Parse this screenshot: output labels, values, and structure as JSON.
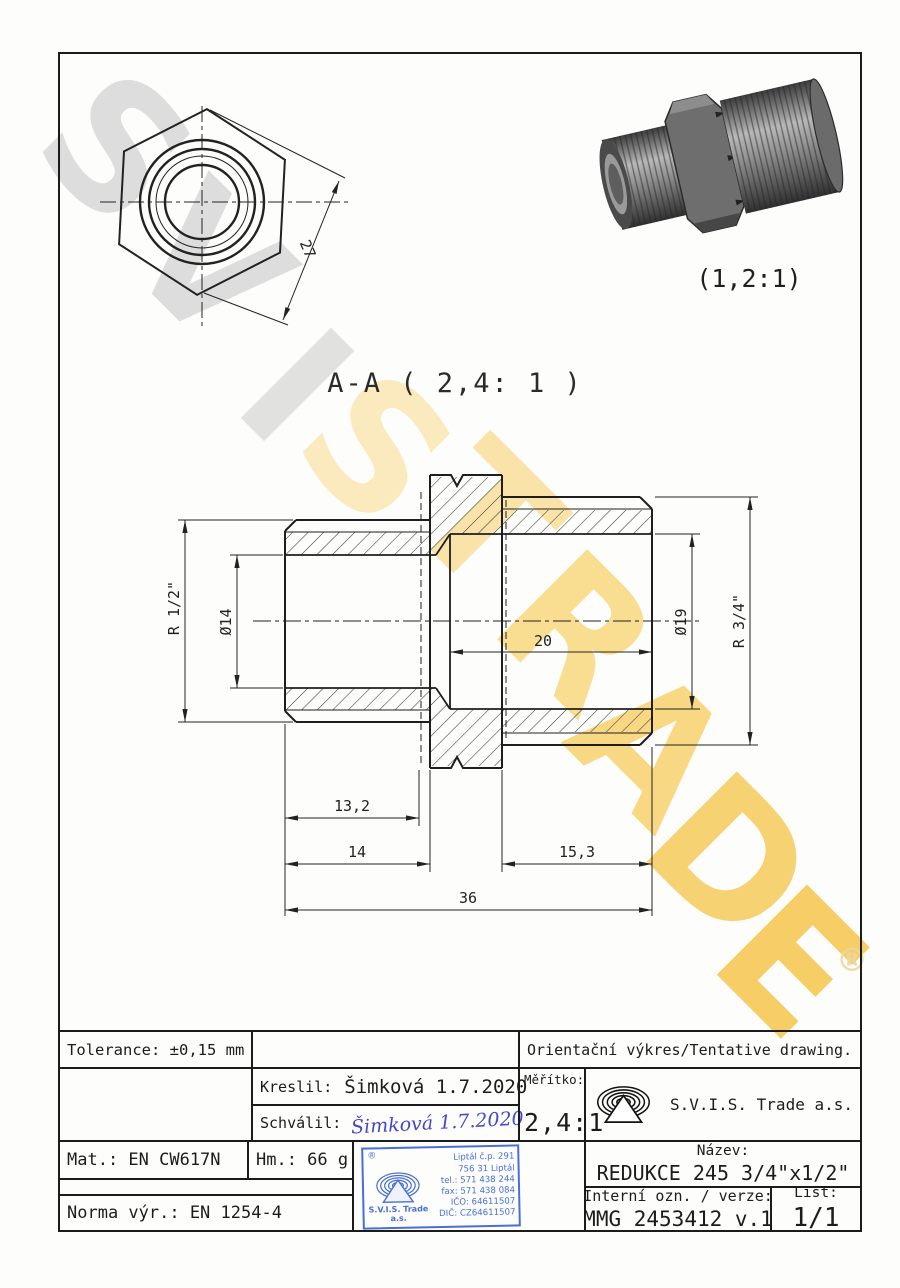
{
  "sheet": {
    "watermark_letters": [
      "S",
      "V",
      "I",
      "S",
      "T",
      "R",
      "A",
      "D",
      "E"
    ],
    "registered_symbol": "®"
  },
  "views": {
    "front_view": {
      "dim_across_flats": "27"
    },
    "iso_view": {
      "scale_label": "(1,2:1)"
    },
    "section_view": {
      "title": "A-A ( 2,4: 1 )",
      "dims": {
        "thread_left": "R 1/2\"",
        "bore_left": "Ø14",
        "bore_right": "Ø19",
        "thread_right": "R 3/4\"",
        "depth_right": "20",
        "len_13_2": "13,2",
        "len_14": "14",
        "len_15_3": "15,3",
        "len_total": "36"
      }
    }
  },
  "title_block": {
    "tolerance": "Tolerance: ±0,15 mm",
    "orientation_note": "Orientační výkres/Tentative drawing.",
    "kreslil_label": "Kreslil:",
    "kreslil_value": "Šimková 1.7.2020",
    "schvalil_label": "Schválil:",
    "schvalil_signature": "Šimková 1.7.2020",
    "meritko_label": "Měřítko:",
    "meritko_value": "2,4:1",
    "company": "S.V.I.S. Trade a.s.",
    "mat": "Mat.: EN CW617N",
    "hm": "Hm.: 66 g",
    "norma": "Norma výr.: EN 1254-4",
    "nazev_label": "Název:",
    "nazev_value": "REDUKCE 245 3/4\"x1/2\"",
    "interni_label": "Interní ozn. / verze:",
    "interni_value": "MMG 2453412 v.1",
    "list_label": "List:",
    "list_value": "1/1"
  },
  "stamp": {
    "registered": "®",
    "company_line1": "S.V.I.S. Trade",
    "company_line2": "a.s.",
    "address_lines": [
      "Liptál č.p. 291",
      "756 31 Liptál",
      "tel.: 571 438 244",
      "fax: 571 438 084",
      "IČO: 64611507",
      "DIČ: CZ64611507"
    ]
  }
}
